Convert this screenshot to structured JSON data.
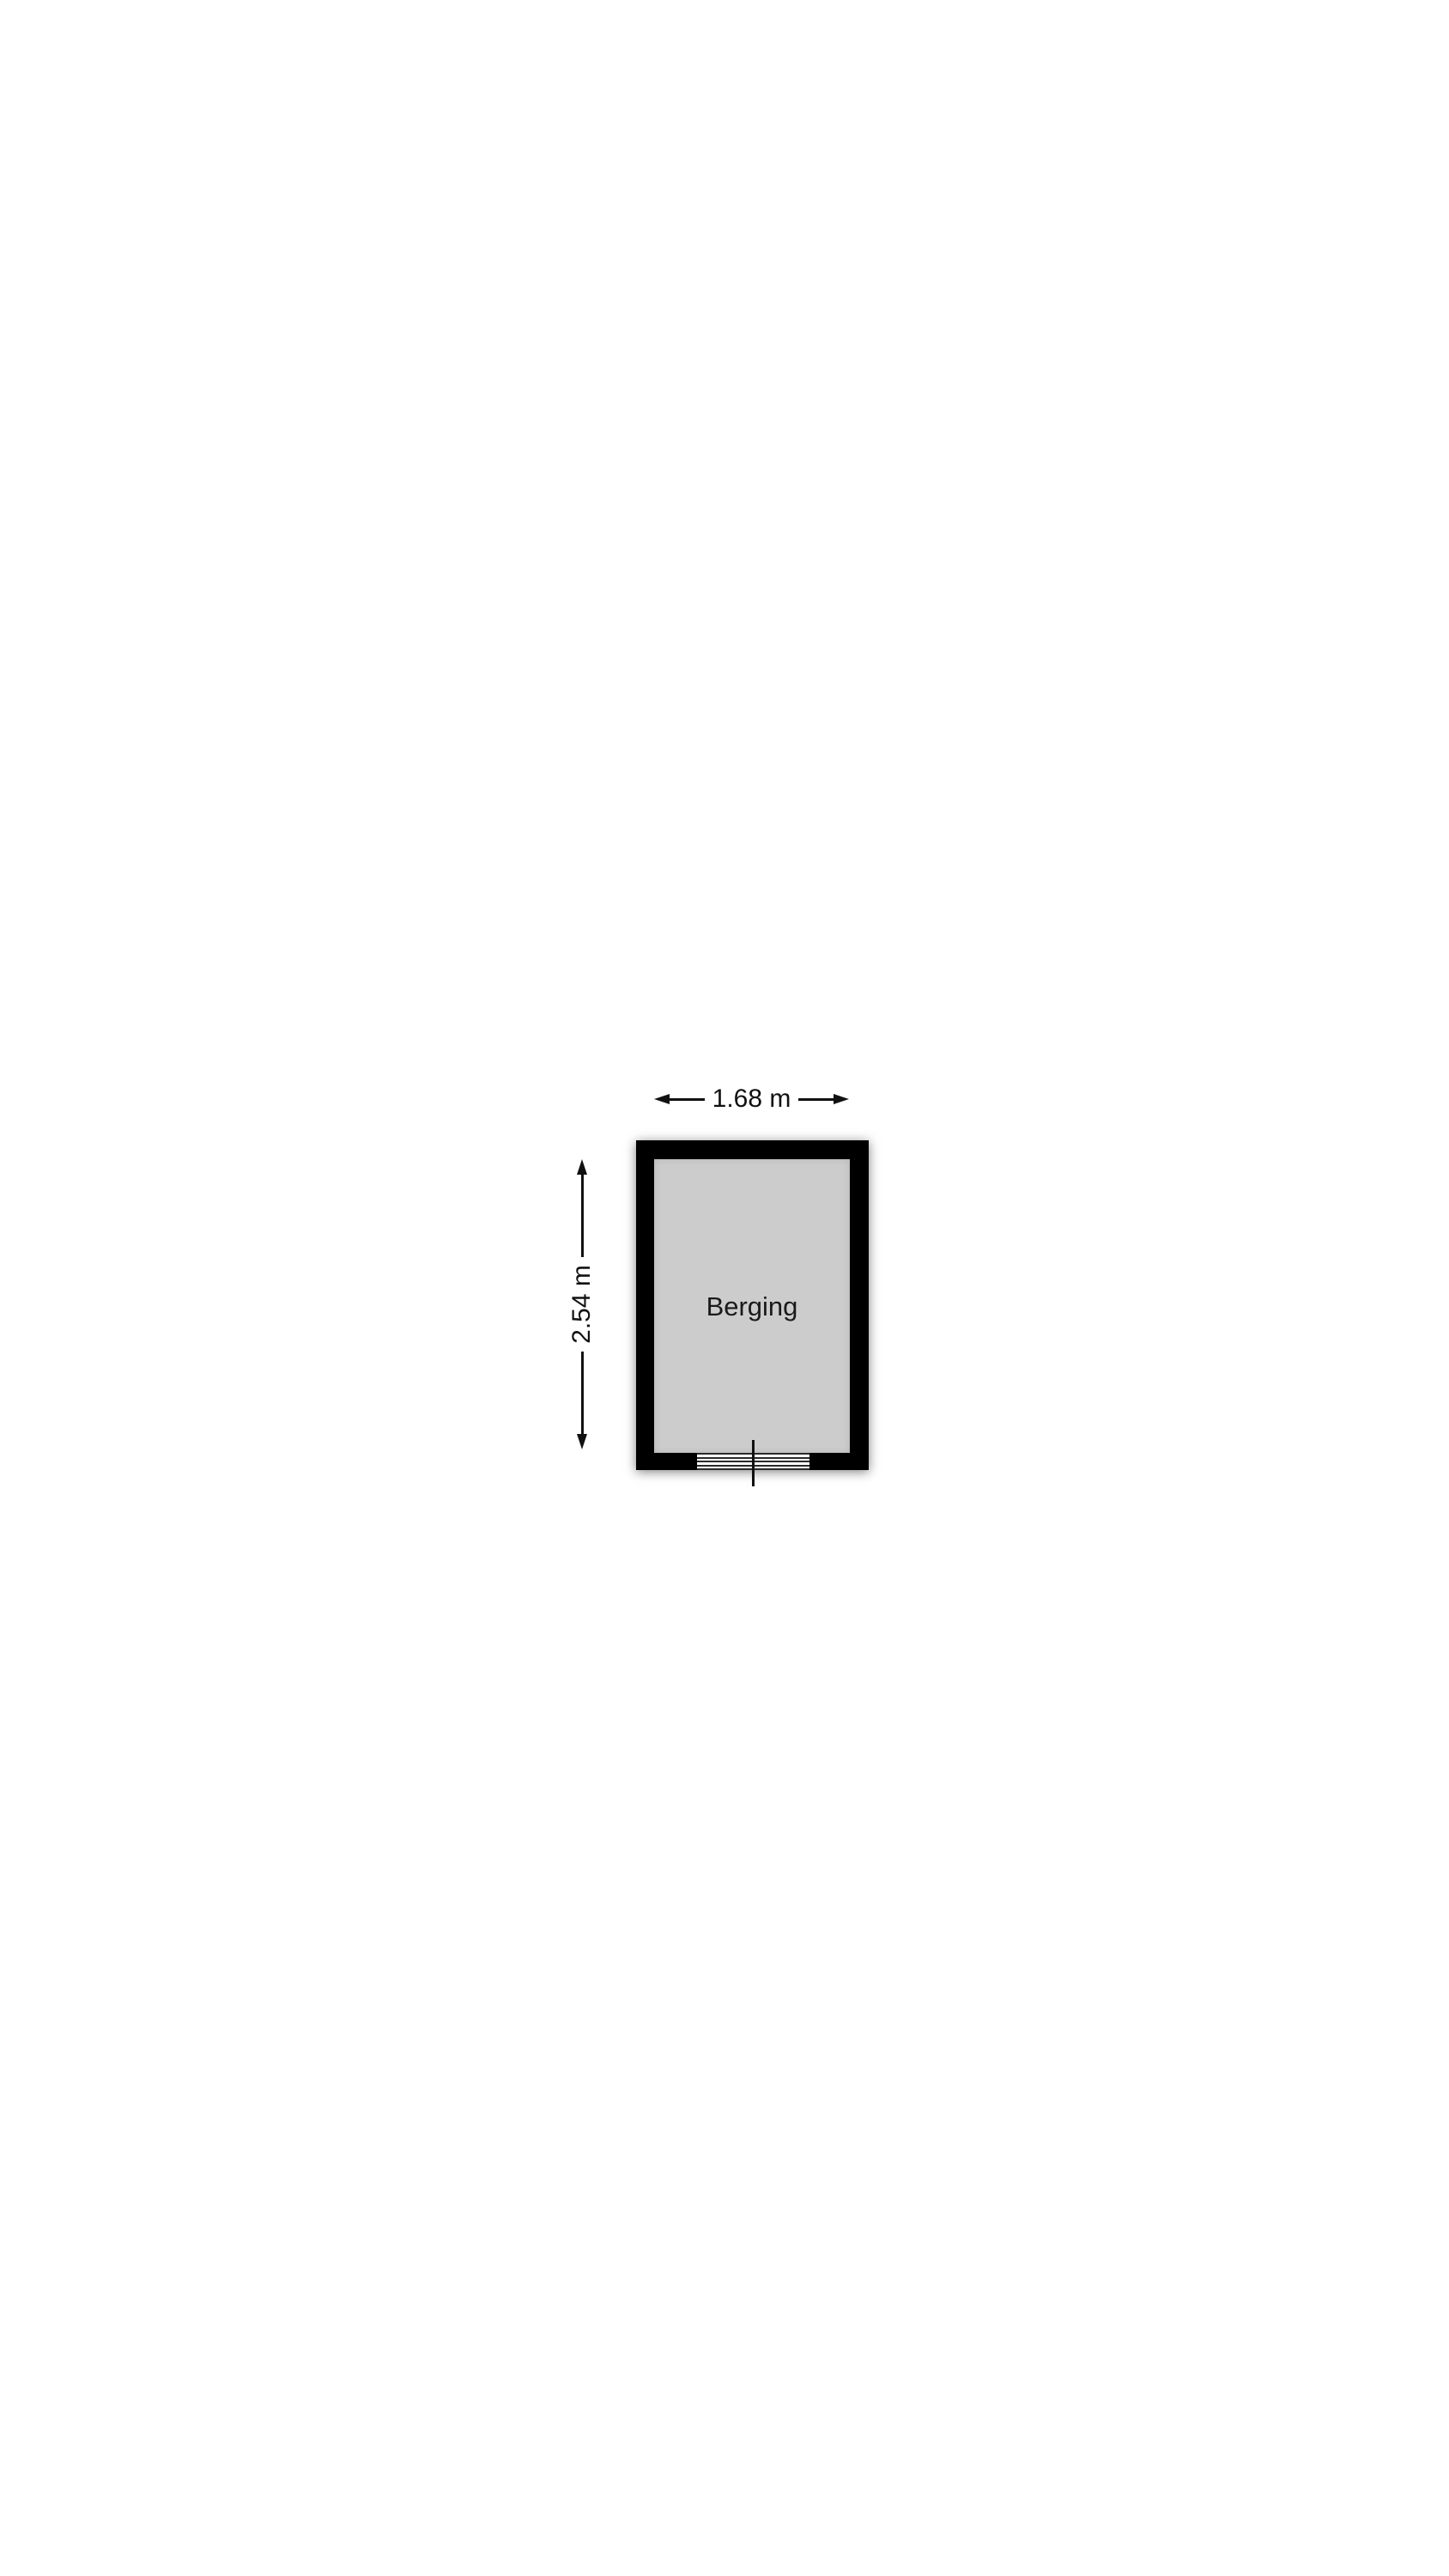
{
  "floorplan": {
    "room": {
      "label": "Berging"
    },
    "dimensions": {
      "width": {
        "label": "1.68 m",
        "meters": 1.68
      },
      "height": {
        "label": "2.54 m",
        "meters": 2.54
      }
    },
    "door": {
      "threshold_line_count": 5
    },
    "colors": {
      "wall": "#000000",
      "floor_fill": "#cccccc",
      "background": "#ffffff",
      "ink": "#111111"
    }
  }
}
